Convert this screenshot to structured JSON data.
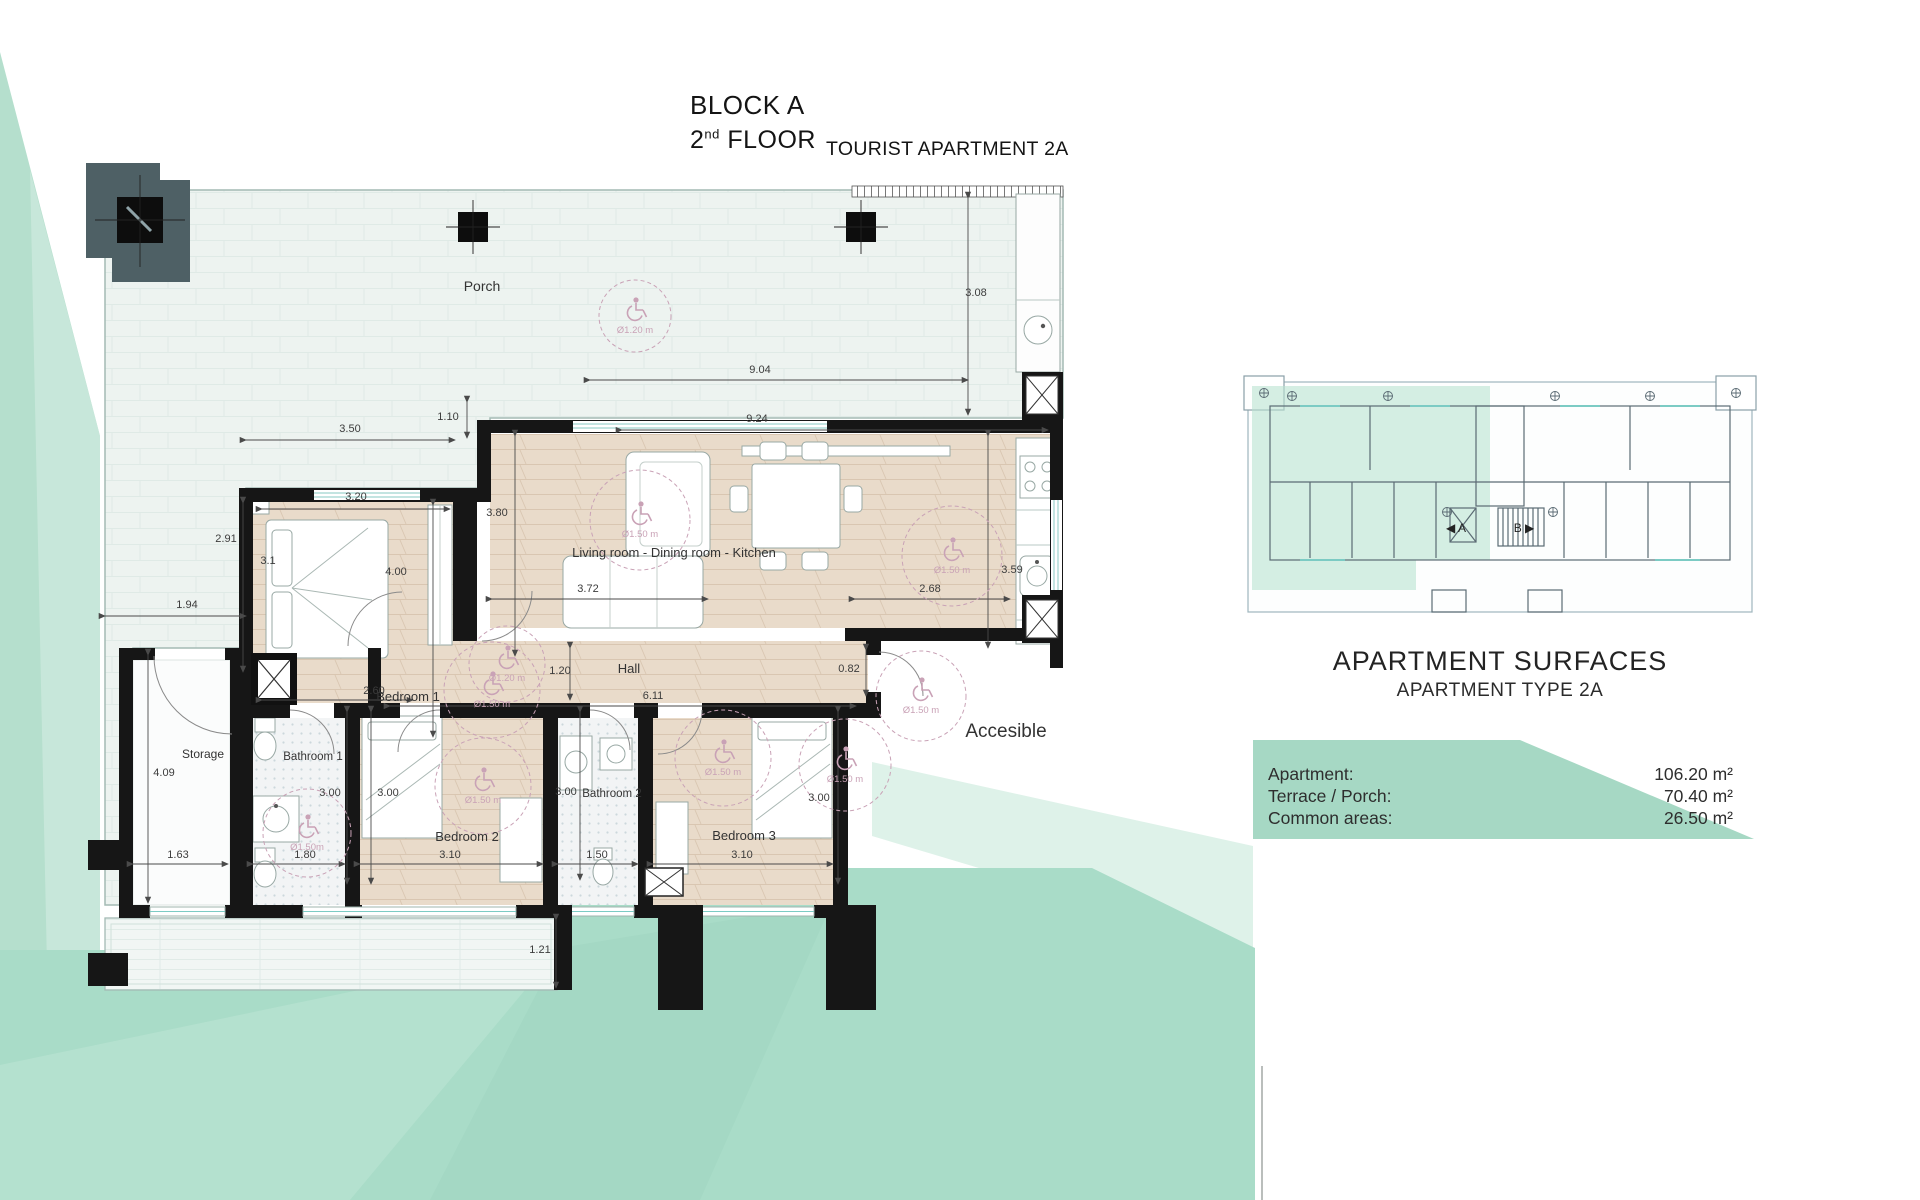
{
  "colors": {
    "mint": "#a9dcc8",
    "mint_wedge": "#b5dfcd",
    "mint_pale": "#def2e9",
    "mint_streak": "#bce4d4",
    "table_green": "#a6d8c4",
    "wall": "#161616",
    "wood": "#e9dbca",
    "porch": "#edf3f0",
    "access_pink": "#c9a2b6",
    "line_gray": "#a3bab4"
  },
  "title": {
    "block": "BLOCK A",
    "floor_num": "2",
    "floor_sup": "nd",
    "floor_word": " FLOOR",
    "apartment": "TOURIST APARTMENT 2A"
  },
  "plan": {
    "dimensions": [
      {
        "t": "3.08",
        "x": 976,
        "y": 296
      },
      {
        "t": "9.04",
        "x": 760,
        "y": 373
      },
      {
        "t": "1.10",
        "x": 448,
        "y": 420
      },
      {
        "t": "3.50",
        "x": 350,
        "y": 432
      },
      {
        "t": "3.20",
        "x": 356,
        "y": 500
      },
      {
        "t": "2.91",
        "x": 226,
        "y": 542
      },
      {
        "t": "1.94",
        "x": 187,
        "y": 608
      },
      {
        "t": "4.00",
        "x": 396,
        "y": 575
      },
      {
        "t": "3.1",
        "x": 268,
        "y": 564,
        "fs": 8
      },
      {
        "t": "3.80",
        "x": 497,
        "y": 516
      },
      {
        "t": "9.24",
        "x": 757,
        "y": 422
      },
      {
        "t": "3.59",
        "x": 1012,
        "y": 573
      },
      {
        "t": "3.72",
        "x": 588,
        "y": 592
      },
      {
        "t": "2.68",
        "x": 930,
        "y": 592
      },
      {
        "t": "1.20",
        "x": 560,
        "y": 674
      },
      {
        "t": "6.11",
        "x": 653,
        "y": 699
      },
      {
        "t": "0.82",
        "x": 849,
        "y": 672,
        "fs": 9
      },
      {
        "t": "2.60",
        "x": 374,
        "y": 694
      },
      {
        "t": "4.09",
        "x": 164,
        "y": 776
      },
      {
        "t": "1.63",
        "x": 178,
        "y": 858
      },
      {
        "t": "1.80",
        "x": 305,
        "y": 858
      },
      {
        "t": "3.10",
        "x": 450,
        "y": 858
      },
      {
        "t": "1.50",
        "x": 597,
        "y": 858
      },
      {
        "t": "3.10",
        "x": 742,
        "y": 858
      },
      {
        "t": "3.00",
        "x": 330,
        "y": 796
      },
      {
        "t": "3.00",
        "x": 388,
        "y": 796
      },
      {
        "t": "3.00",
        "x": 566,
        "y": 795
      },
      {
        "t": "3.00",
        "x": 819,
        "y": 801
      },
      {
        "t": "1.21",
        "x": 540,
        "y": 953
      }
    ],
    "room_labels": [
      {
        "t": "Porch",
        "x": 482,
        "y": 291,
        "fs": 14
      },
      {
        "t": "Bedroom 1",
        "x": 408,
        "y": 701,
        "fs": 13
      },
      {
        "t": "Living room - Dining room - Kitchen",
        "x": 674,
        "y": 557,
        "fs": 13
      },
      {
        "t": "Hall",
        "x": 629,
        "y": 673,
        "fs": 13
      },
      {
        "t": "Storage",
        "x": 203,
        "y": 758,
        "fs": 12
      },
      {
        "t": "Bathroom 1",
        "x": 313,
        "y": 760,
        "fs": 11.5
      },
      {
        "t": "Bedroom 2",
        "x": 467,
        "y": 841,
        "fs": 13
      },
      {
        "t": "Bathroom 2",
        "x": 612,
        "y": 797,
        "fs": 11.5
      },
      {
        "t": "Bedroom 3",
        "x": 744,
        "y": 840,
        "fs": 13
      },
      {
        "t": "Accesible",
        "x": 1006,
        "y": 737,
        "fs": 19,
        "color": "#4a4a4a"
      }
    ],
    "access_circles": [
      {
        "label": "Ø1.20 m",
        "cx": 635,
        "cy": 316,
        "r": 36
      },
      {
        "label": "Ø1.20 m",
        "cx": 507,
        "cy": 664,
        "r": 38
      },
      {
        "label": "Ø1.50 m",
        "cx": 640,
        "cy": 520,
        "r": 50
      },
      {
        "label": "Ø1.50 m",
        "cx": 952,
        "cy": 556,
        "r": 50
      },
      {
        "label": "Ø1.50 m",
        "cx": 723,
        "cy": 758,
        "r": 48
      },
      {
        "label": "Ø1.50 m",
        "cx": 483,
        "cy": 786,
        "r": 48
      },
      {
        "label": "Ø1.50m",
        "cx": 307,
        "cy": 833,
        "r": 44
      },
      {
        "label": "Ø1.50 m",
        "cx": 492,
        "cy": 690,
        "r": 48
      },
      {
        "label": "Ø1.50 m",
        "cx": 845,
        "cy": 765,
        "r": 46
      },
      {
        "label": "Ø1.50 m",
        "cx": 921,
        "cy": 696,
        "r": 45
      }
    ]
  },
  "key_plan": {
    "label_a": "◀ A",
    "label_b": "B ▶"
  },
  "surfaces": {
    "title": "APARTMENT SURFACES",
    "subtitle": "APARTMENT TYPE 2A",
    "rows": [
      {
        "label": "Apartment:",
        "value": "106.20 m²"
      },
      {
        "label": "Terrace / Porch:",
        "value": "70.40 m²"
      },
      {
        "label": "Common areas:",
        "value": "26.50 m²"
      }
    ]
  }
}
